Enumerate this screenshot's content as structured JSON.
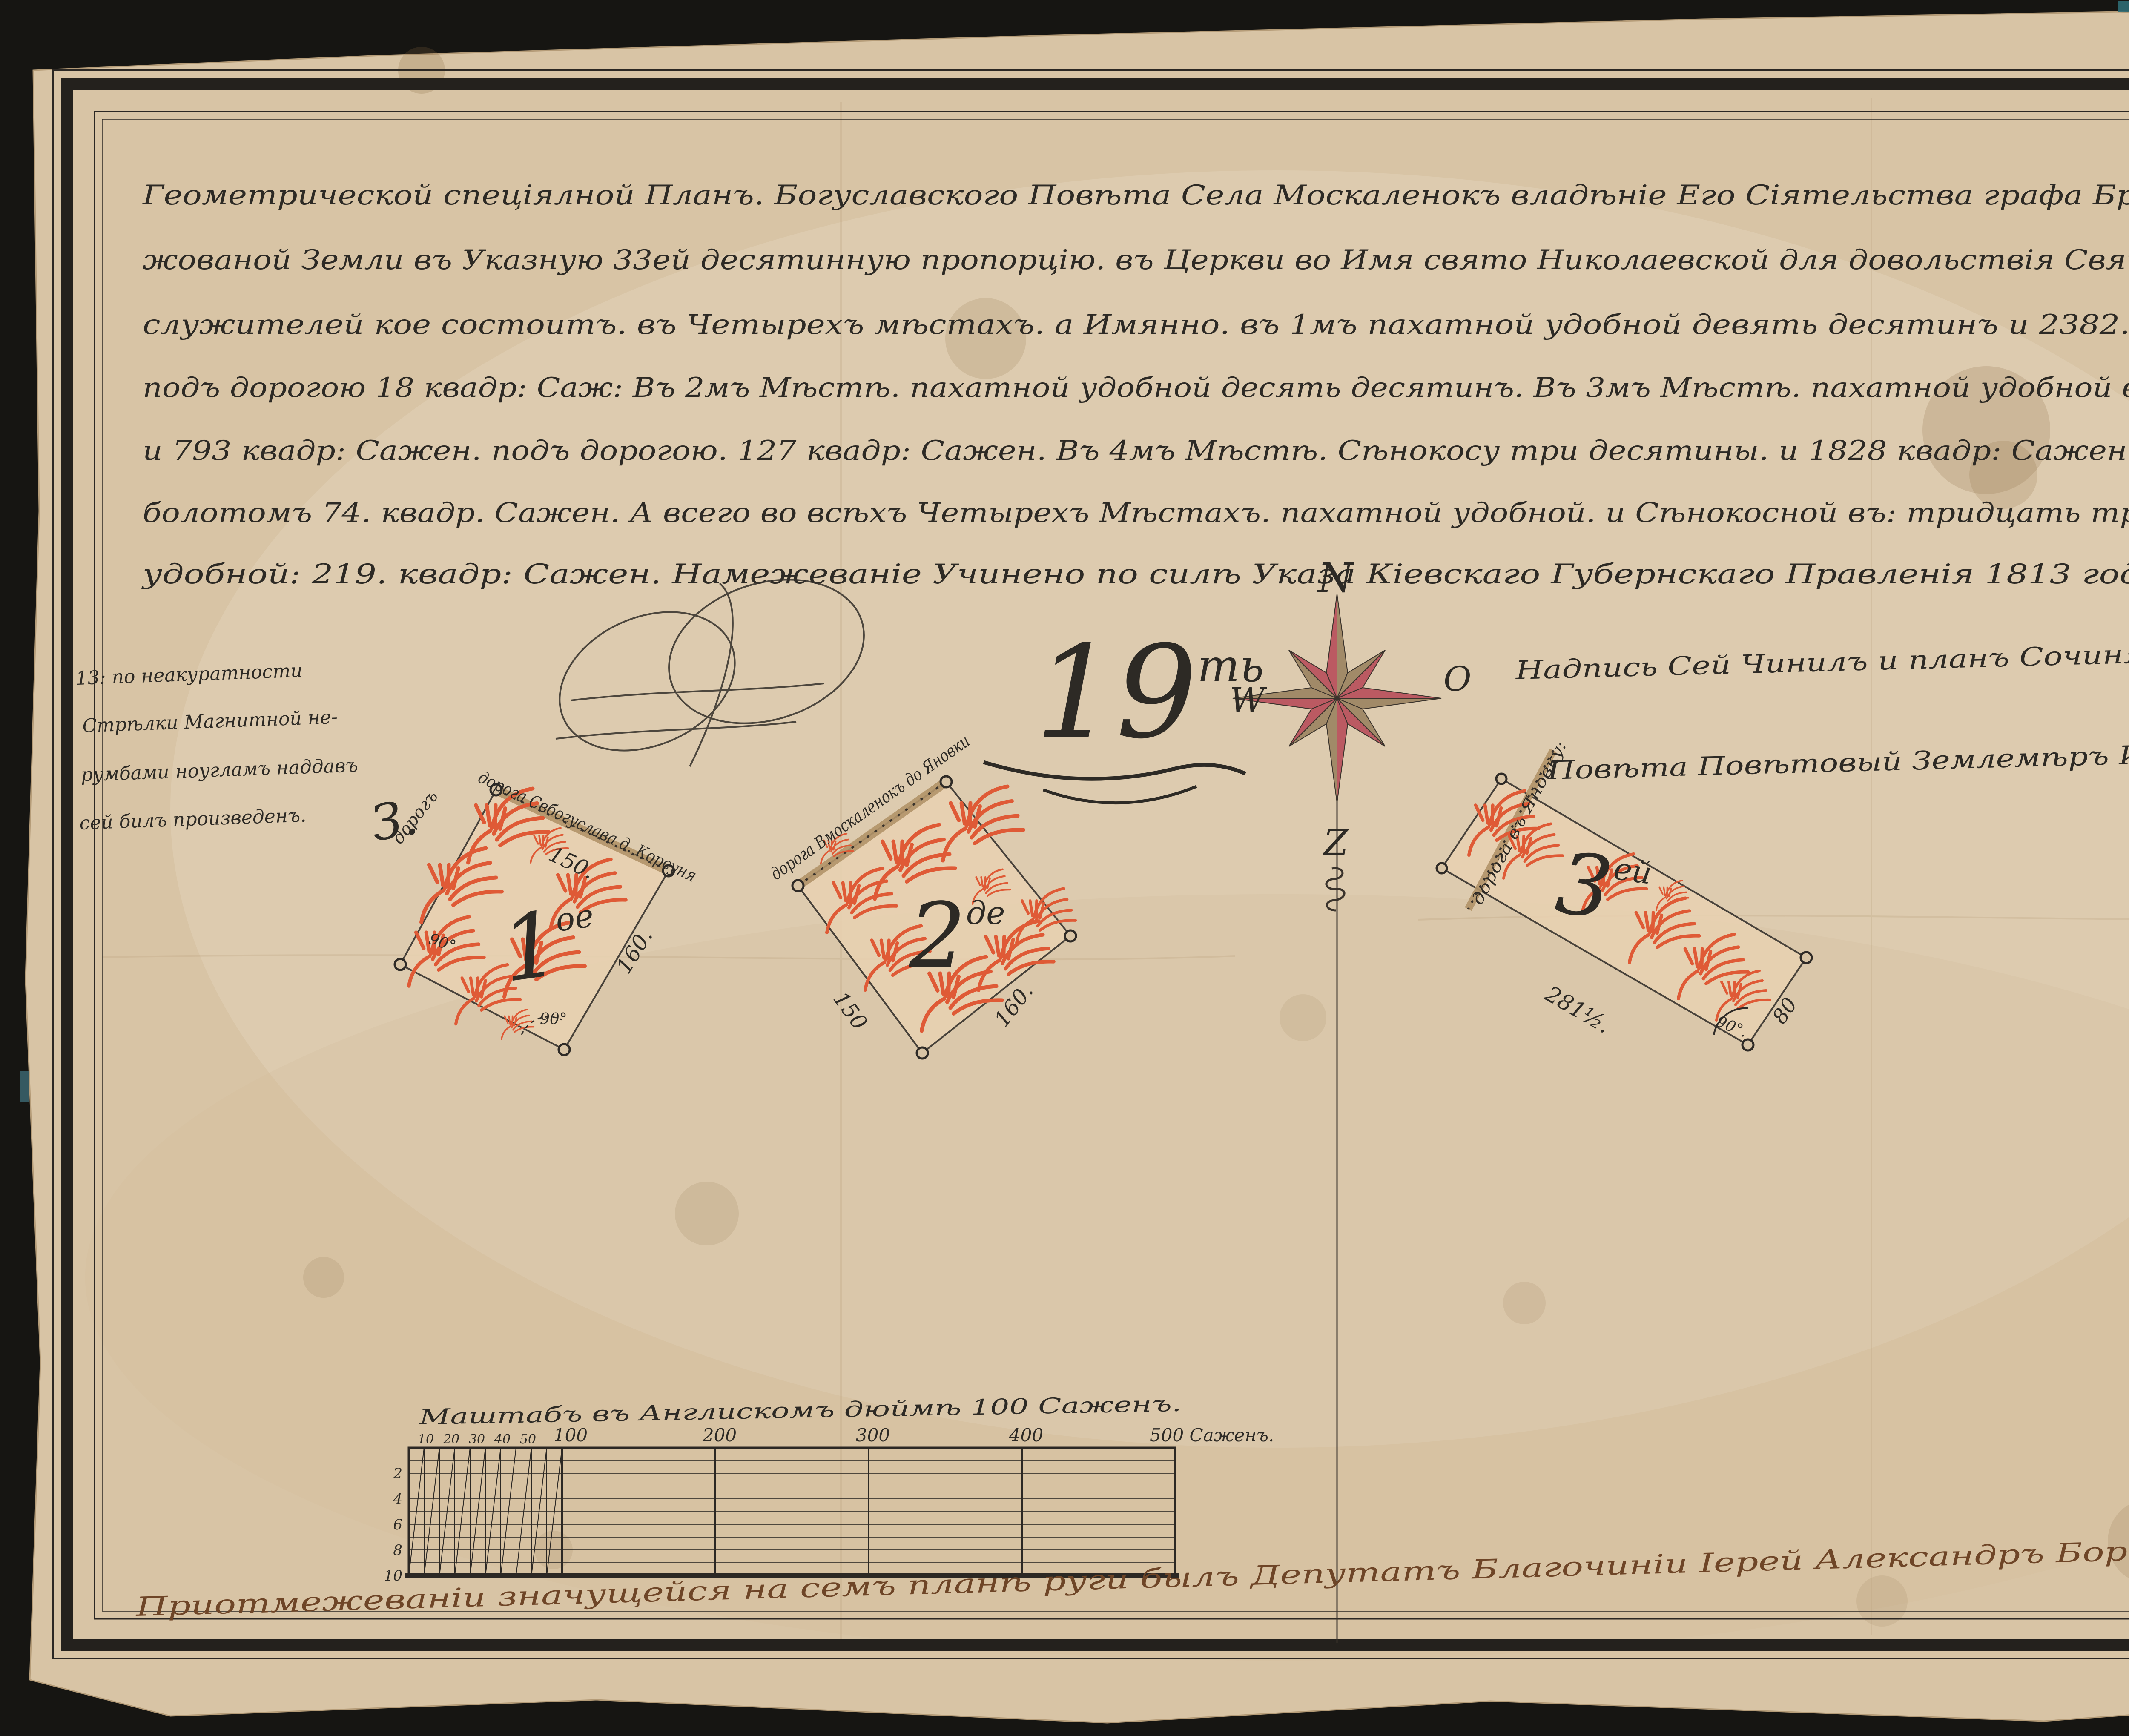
{
  "page": {
    "number": "4"
  },
  "header": {
    "lines": [
      "Геометрической спеціялной Планъ. Богуславского Повѣта Села Москаленокъ владѣніе Его Сіятельства графа Браницкаго отме-",
      "жованой Земли въ Указную 33ей десятинную пропорцію. въ Церкви во Имя свято Николаевской для довольствія Священо ицерковно-",
      "служителей кое состоитъ. въ Четырехъ мѣстахъ. а Имянно. въ 1мъ пахатной удобной девять десятинъ и 2382. квадр: Саженъ.",
      "подъ дорогою 18 квадр: Саж: Въ 2мъ Мѣстѣ. пахатной удобной десять десятинъ. Въ 3мъ Мѣстѣ. пахатной удобной восемь десятинъ",
      "и 793 квадр: Сажен. подъ дорогою. 127 квадр: Сажен. Въ 4мъ Мѣстѣ. Сѣнокосу три десятины. и 1828 квадр: Сажен. неудобной подъ",
      "болотомъ 74. квадр. Сажен. А всего во всѣхъ Четырехъ Мѣстахъ. пахатной удобной. и Сѣнокосной въ: тридцать три десятины. не-",
      "удобной: 219. квадр: Сажен. Намежеваніе Учинено по силѣ Указа Кіевскаго Губернскаго Правленія 1813 года Іюня 29 дня"
    ]
  },
  "margin_note": {
    "lines": [
      "13: по неакуратности",
      "Стрѣлки Магнитной не-",
      "румбами ноугламъ наддавъ",
      "сей билъ произведенъ."
    ],
    "extra": "дорогъ",
    "flourish": "З."
  },
  "mark19": {
    "value": "19",
    "sup": "ть"
  },
  "compass": {
    "n": "N",
    "w": "W",
    "o": "O",
    "z": "Z"
  },
  "surveyor": {
    "line1": "Надпись Сей Чинилъ и планъ Сочинялъ Богуславскаго",
    "line2": "Повѣта Повѣтовый Землемѣръ Иванъ Шмигельской"
  },
  "parcels": {
    "p1": {
      "number": "1",
      "sup": "ое",
      "road": "дорога Свбогуслава д. Корсуня",
      "len_top": "150.",
      "len_right": "160.",
      "angle_left": "90°",
      "angle_bottom": "90°"
    },
    "p2": {
      "number": "2",
      "sup": "де",
      "road": "дорога Вмоскаленокъ до Яновки",
      "len_left": "150",
      "len_right": "160."
    },
    "p3": {
      "number": "3",
      "sup": "ей",
      "road": "дорога въ Яновку:",
      "len_bottom": "281½.",
      "len_right": "80",
      "angle": "90°."
    },
    "p4": {
      "number": "4",
      "sup": "е",
      "label_area": "урочище отъ",
      "label_village": "Села",
      "river_name_1": "Рѣчки Пишовъ",
      "river_name_2": "нехворощъ:",
      "len_bottom": "121,2.",
      "len_right": "36,2"
    }
  },
  "scale_bar": {
    "title": "Маштабъ въ Англискомъ дюймѣ 100 Саженъ.",
    "minor_ticks": [
      "10",
      "20",
      "30",
      "40",
      "50"
    ],
    "major_ticks": [
      "100",
      "200",
      "300",
      "400"
    ],
    "end_label": "500 Саженъ.",
    "row_labels": [
      "2",
      "4",
      "6",
      "8",
      "10"
    ]
  },
  "footer": {
    "text": "Приотмежеваніи значущейся на семъ планѣ руги былъ Депутатъ Благочиніи Іерей Александръ Боровскій"
  },
  "colors": {
    "paper": "#d8c4a5",
    "ink": "#2d2a25",
    "brown_ink": "#6e4527",
    "vegetation_red": "#df5a36",
    "compass_red": "#bb5a62",
    "compass_tan": "#a18a68",
    "road_tan": "#b29469",
    "river_blue": "#a9b8c0",
    "frame_black": "#24211d"
  }
}
